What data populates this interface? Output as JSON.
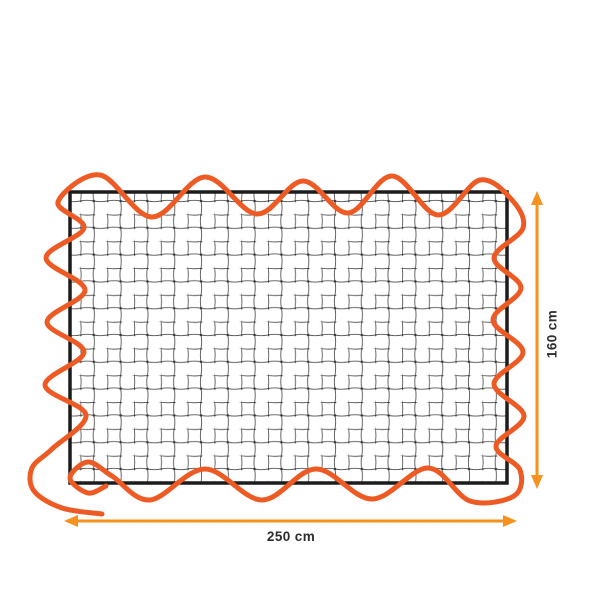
{
  "labels": {
    "width": "250 cm",
    "height": "160 cm"
  },
  "colors": {
    "background": "#ffffff",
    "cord": "#ee5a24",
    "arrow": "#f6921e",
    "frame": "#1c1c1c",
    "mesh_line": "#565656",
    "mesh_knot": "#383838",
    "label_text": "#2d2d2d"
  },
  "icons": {
    "width_arrow": "double-arrow-horizontal-icon",
    "height_arrow": "double-arrow-vertical-icon"
  }
}
